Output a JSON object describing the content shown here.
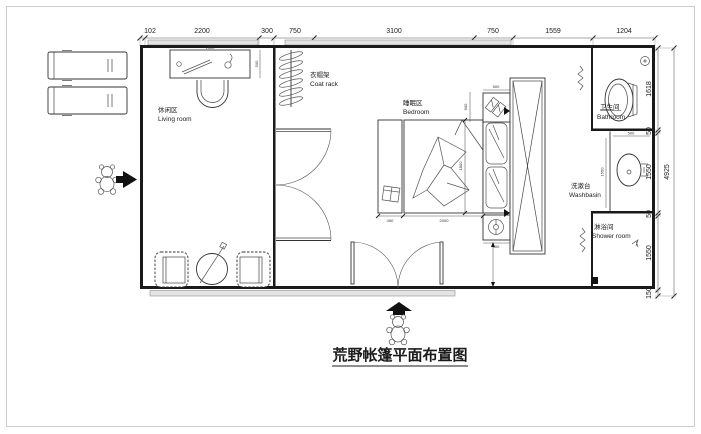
{
  "title": {
    "text": "荒野帐篷平面布置图"
  },
  "rooms": {
    "living": {
      "zh": "休闲区",
      "en": "Living room"
    },
    "coat": {
      "zh": "衣帽架",
      "en": "Coat rack"
    },
    "bedroom": {
      "zh": "睡眠区",
      "en": "Bedroom"
    },
    "bathroom": {
      "zh": "卫生间",
      "en": "Bathroom"
    },
    "washbasin": {
      "zh": "洗漱台",
      "en": "Washbasin"
    },
    "shower": {
      "zh": "淋浴间",
      "en": "Shower room"
    }
  },
  "dims": {
    "top": [
      "102",
      "2200",
      "300",
      "750",
      "3100",
      "750",
      "1559",
      "1204"
    ],
    "right": [
      "1618",
      "50",
      "1550",
      "50",
      "1550",
      "150"
    ],
    "right_overall": "4925",
    "interior": {
      "desk_w": "1500",
      "desk_d": "500",
      "bedside_w": "450",
      "bed_l": "2000",
      "bed_w": "1800",
      "slipper_w": "500",
      "headboard_h": "600",
      "lamp_w": "500",
      "washbasin_d": "1550",
      "basin_w": "500"
    }
  },
  "icons": {
    "entrance_left": "arrow-right",
    "entrance_bottom": "arrow-up",
    "mascot": "teddy-bear-sketch"
  },
  "colors": {
    "wall": "#1a1a1a",
    "dimension": "#333333",
    "window_band": "#e3e3e3",
    "sketch": "#555555",
    "background": "#ffffff"
  }
}
